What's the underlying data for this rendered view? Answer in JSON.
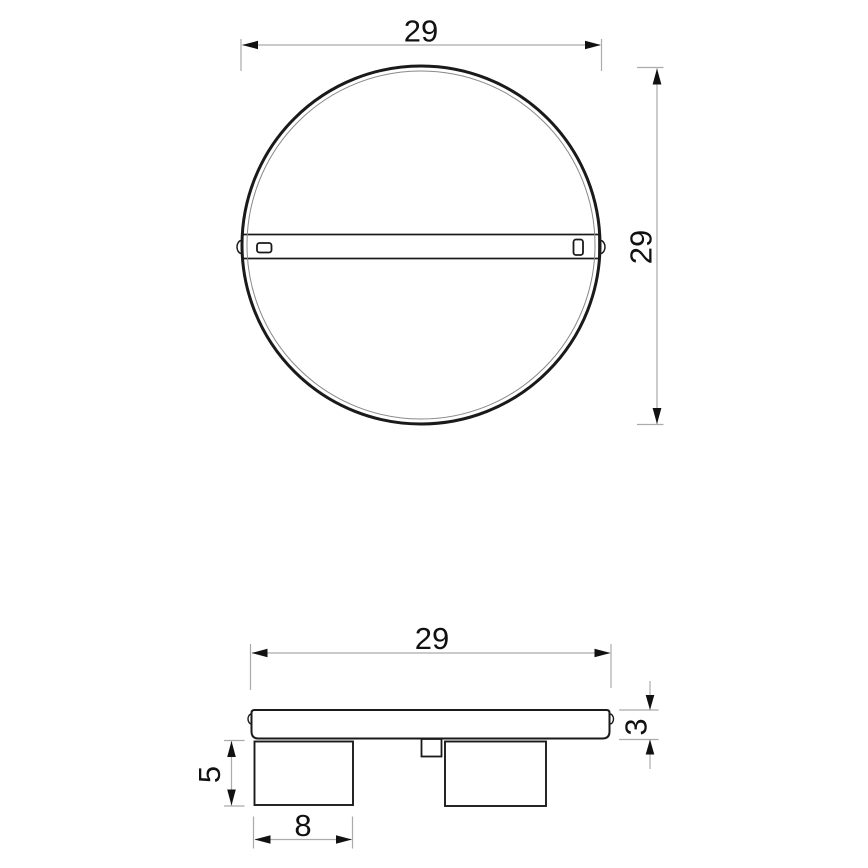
{
  "drawing": {
    "dims": {
      "top_view_width": "29",
      "top_view_height": "29",
      "side_view_width": "29",
      "plate_thickness": "3",
      "spot_height": "5",
      "spot_width": "8"
    },
    "colors": {
      "object_line": "#1a1a1a",
      "dimension_line": "#ababab",
      "text": "#111111",
      "background": "#ffffff"
    }
  }
}
